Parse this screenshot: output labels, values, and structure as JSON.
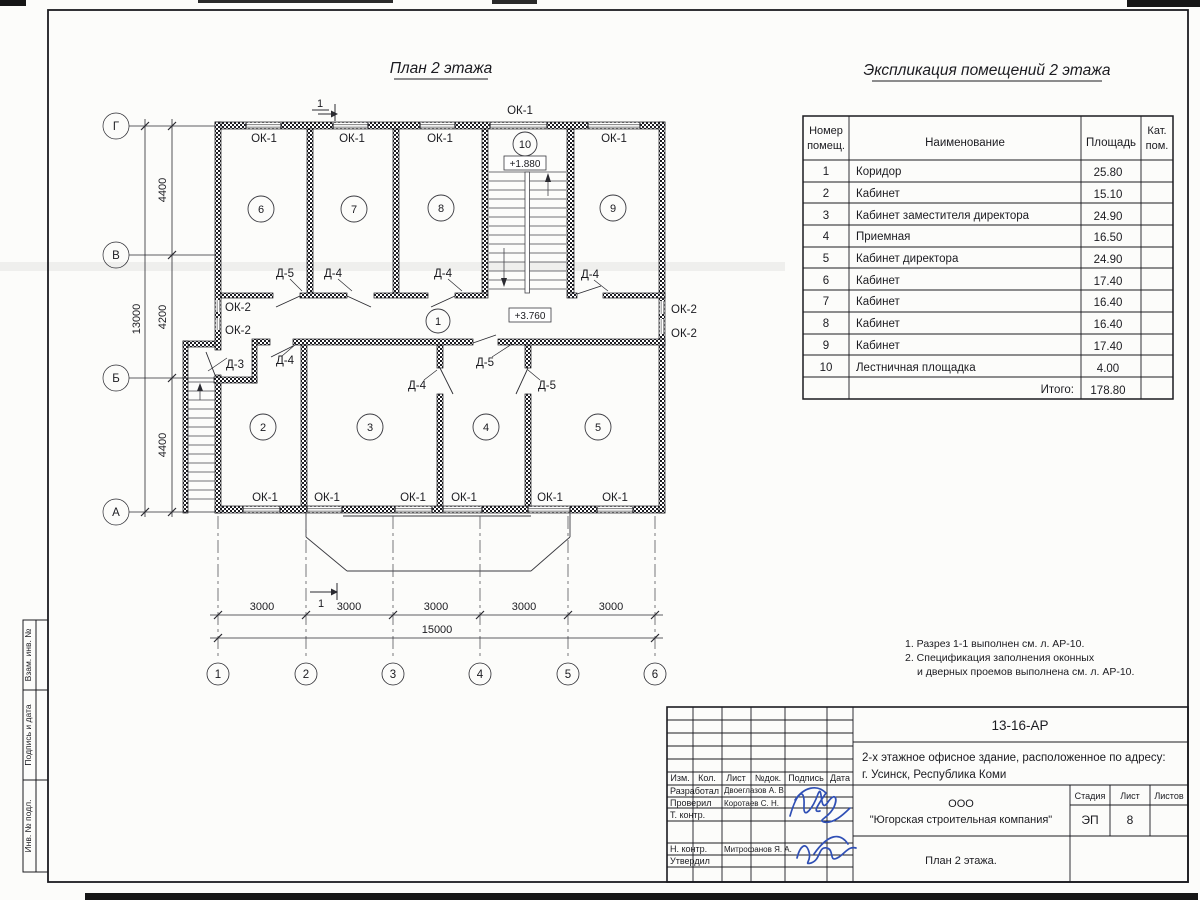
{
  "sheet": {
    "plan_title": "План 2 этажа",
    "table_title": "Экспликация помещений 2 этажа",
    "notes": [
      "1. Разрез 1-1 выполнен см. л. АР-10.",
      "2. Спецификация заполнения оконных",
      "и дверных проемов выполнена см. л. АР-10."
    ]
  },
  "table": {
    "headers": {
      "num1": "Номер",
      "num2": "помещ.",
      "name": "Наименование",
      "area": "Площадь",
      "cat1": "Кат.",
      "cat2": "пом."
    },
    "rows": [
      {
        "num": "1",
        "name": "Коридор",
        "area": "25.80"
      },
      {
        "num": "2",
        "name": "Кабинет",
        "area": "15.10"
      },
      {
        "num": "3",
        "name": "Кабинет заместителя директора",
        "area": "24.90"
      },
      {
        "num": "4",
        "name": "Приемная",
        "area": "16.50"
      },
      {
        "num": "5",
        "name": "Кабинет директора",
        "area": "24.90"
      },
      {
        "num": "6",
        "name": "Кабинет",
        "area": "17.40"
      },
      {
        "num": "7",
        "name": "Кабинет",
        "area": "16.40"
      },
      {
        "num": "8",
        "name": "Кабинет",
        "area": "16.40"
      },
      {
        "num": "9",
        "name": "Кабинет",
        "area": "17.40"
      },
      {
        "num": "10",
        "name": "Лестничная площадка",
        "area": "4.00"
      }
    ],
    "total_label": "Итого:",
    "total_value": "178.80"
  },
  "plan": {
    "labels": {
      "ok1": "ОК-1",
      "ok2": "ОК-2",
      "d3": "Д-3",
      "d4": "Д-4",
      "d5": "Д-5"
    },
    "levels": {
      "stair": "+1.880",
      "corridor": "+3.760"
    },
    "rooms": {
      "r1": "1",
      "r2": "2",
      "r3": "3",
      "r4": "4",
      "r5": "5",
      "r6": "6",
      "r7": "7",
      "r8": "8",
      "r9": "9",
      "r10": "10"
    },
    "axes_rows": [
      "Г",
      "В",
      "Б",
      "А"
    ],
    "axes_cols": [
      "1",
      "2",
      "3",
      "4",
      "5",
      "6"
    ],
    "dims": {
      "bay": "3000",
      "total_w": "15000",
      "v1": "4400",
      "v2": "4200",
      "v3": "4400",
      "total_h": "13000"
    },
    "section_mark": "1"
  },
  "titleblock": {
    "doc_number": "13-16-АР",
    "object_line1": "2-х этажное офисное здание, расположенное по адресу:",
    "object_line2": "г. Усинск, Республика Коми",
    "company_line1": "ООО",
    "company_line2": "\"Югорская строительная компания\"",
    "sheet_name": "План 2 этажа.",
    "stage_label": "Стадия",
    "stage": "ЭП",
    "sheet_label": "Лист",
    "sheet_number": "8",
    "sheets_label": "Листов",
    "cols": {
      "izm": "Изм.",
      "kol": "Кол.",
      "list": "Лист",
      "ndoc": "№док.",
      "sign": "Подпись",
      "date": "Дата"
    },
    "roles": {
      "developed": "Разработал",
      "checked": "Проверил",
      "tcontrol": "Т. контр.",
      "ncontrol": "Н. контр.",
      "approved": "Утвердил"
    },
    "people": {
      "developed": "Двоеглазов А. В.",
      "checked": "Коротаев С. Н.",
      "ncontrol": "Митрофанов Я. А."
    }
  },
  "margin_stamps": [
    "Взам. инв. №",
    "Подпись и дата",
    "Инв. № подл."
  ],
  "colors": {
    "ink": "#1b1b20",
    "window_line": "#8f8f8f",
    "signature": "#2f4fb5",
    "scan_mark": "#161616"
  }
}
